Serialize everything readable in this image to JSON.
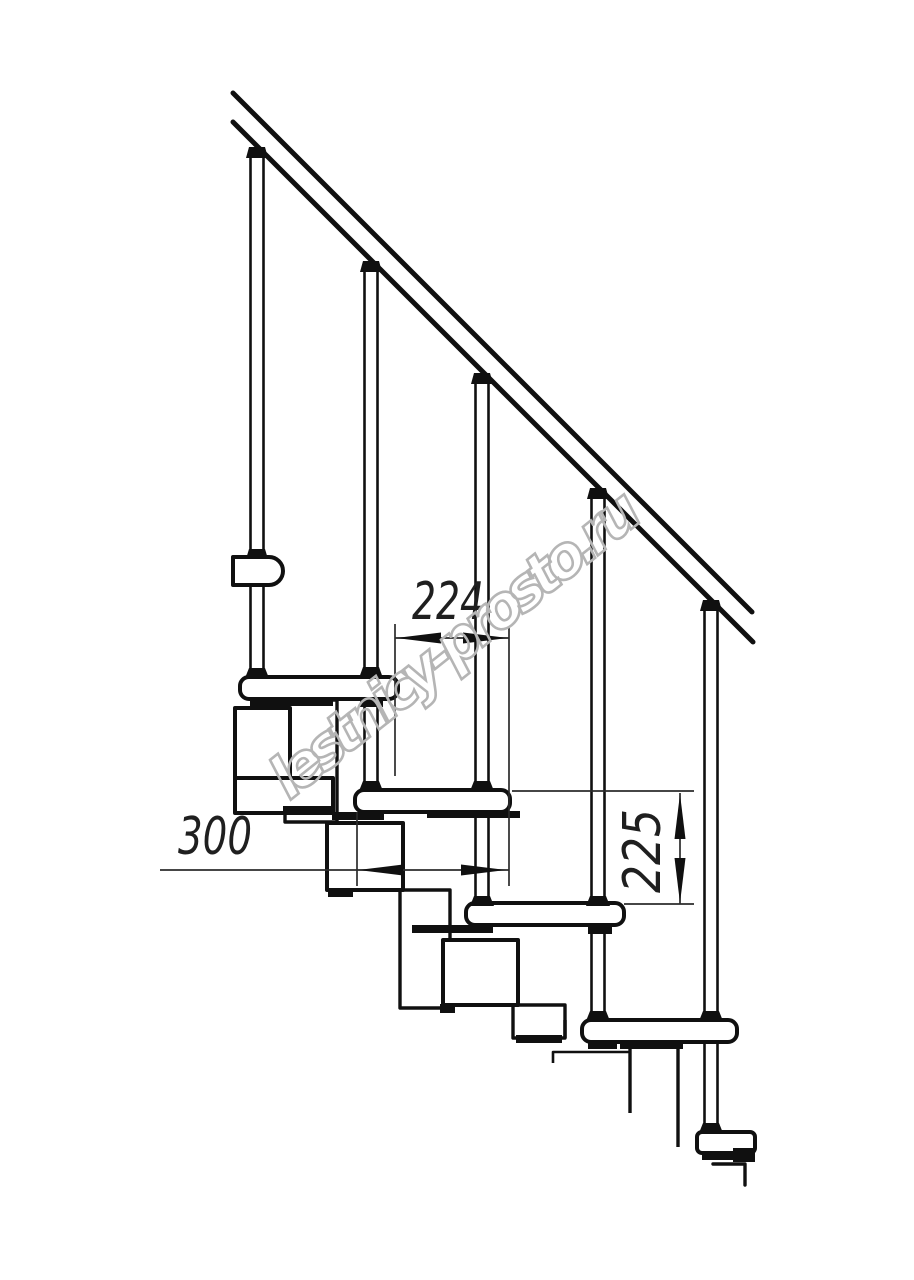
{
  "drawing": {
    "kind": "modular-staircase-side-view-technical-drawing",
    "background_color": "#ffffff",
    "line_color": "#101010",
    "dimension_line_color": "#2b2b2b",
    "dimensions": {
      "tread_offset": {
        "value": "224",
        "orientation": "horizontal"
      },
      "tread_length": {
        "value": "300",
        "orientation": "horizontal"
      },
      "riser_height": {
        "value": "225",
        "orientation": "vertical"
      }
    },
    "watermark": {
      "text": "lestnicy-prosto.ru",
      "color": "#b5b5b5"
    },
    "parts": {
      "handrail": "handrail",
      "balusters": [
        "baluster-1",
        "baluster-2",
        "baluster-3",
        "baluster-4",
        "baluster-5"
      ],
      "treads": [
        "tread-1",
        "tread-2",
        "tread-3",
        "tread-4",
        "tread-5"
      ],
      "modules": [
        "upper-flight-tread-edge",
        "landing-bracket",
        "module-1",
        "module-2",
        "module-3",
        "module-4"
      ]
    }
  }
}
